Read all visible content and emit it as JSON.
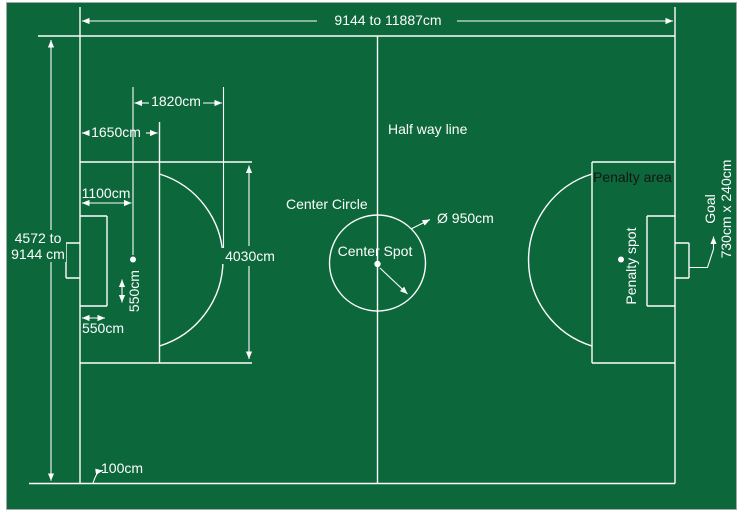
{
  "field": {
    "length_label": "9144 to 11887cm",
    "width_label_line1": "4572 to",
    "width_label_line2": "9144 cm",
    "line_width_label": "100cm"
  },
  "left_half": {
    "spot_to_arc_label": "1820cm",
    "penalty_area_depth_label": "1650cm",
    "penalty_spot_distance_label": "1100cm",
    "penalty_area_width_label": "4030cm",
    "goal_area_side_label": "550cm",
    "goal_area_depth_label": "550cm"
  },
  "center": {
    "half_way_line_label": "Half way line",
    "center_circle_label": "Center Circle",
    "center_spot_label": "Center Spot",
    "circle_diameter_label": "Ø 950cm"
  },
  "right_half": {
    "penalty_area_label": "Penalty area",
    "penalty_spot_label": "Penalty spot",
    "goal_label_line1": "Goal",
    "goal_label_line2": "730cm x 240cm"
  },
  "colors": {
    "field_green": "#0c683b",
    "line_white": "#fdfdfd",
    "dark_text": "#151515",
    "border_gray": "#a3aaa3"
  }
}
